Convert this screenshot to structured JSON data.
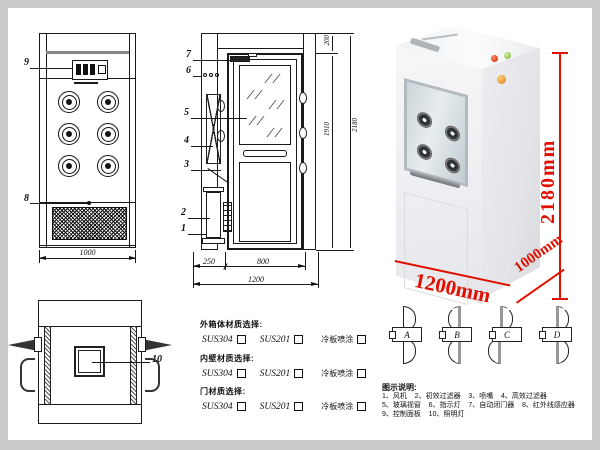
{
  "front_view": {
    "label_control_panel": "9",
    "label_grille": "8",
    "dim_width": "1000"
  },
  "top_view": {
    "label_light": "10"
  },
  "section_view": {
    "labels": {
      "door_closer": "7",
      "indicator": "6",
      "glass": "5",
      "filter": "4",
      "nozzle": "3",
      "prefilter": "2",
      "fan": "1"
    },
    "dims": {
      "left_section": "250",
      "door_width": "800",
      "total_width": "1200",
      "top_height": "200",
      "door_height": "1910",
      "total_height": "2180"
    }
  },
  "photo": {
    "dim_height": "2180mm",
    "dim_width": "1200mm",
    "dim_depth": "1000mm"
  },
  "materials": {
    "groups": [
      {
        "title": "外箱体材质选择:",
        "options": [
          "SUS304",
          "SUS201",
          "冷板喷涂"
        ]
      },
      {
        "title": "内壁材质选择:",
        "options": [
          "SUS304",
          "SUS201",
          "冷板喷涂"
        ]
      },
      {
        "title": "门材质选择:",
        "options": [
          "SUS304",
          "SUS201",
          "冷板喷涂"
        ]
      }
    ]
  },
  "door_options": {
    "items": [
      "A",
      "B",
      "C",
      "D"
    ]
  },
  "legend": {
    "title": "图示说明:",
    "lines": [
      "1、风机    2、初效过滤器    3、喷嘴    4、高效过滤器",
      "5、玻璃视窗    6、指示灯    7、自动闭门器    8、红外线感应器",
      "9、控制面板    10、照明灯"
    ]
  },
  "colors": {
    "dim_red": "#e01000",
    "line": "#1a1a1a",
    "frame": "#c9cac9"
  }
}
